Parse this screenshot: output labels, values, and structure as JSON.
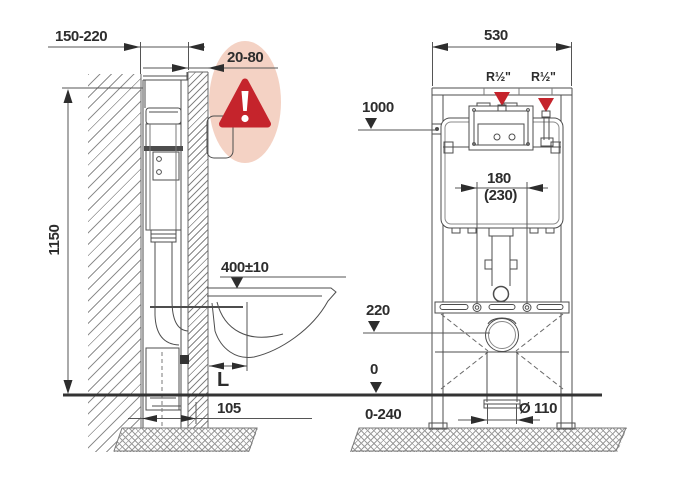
{
  "diagram_title": "wall-hung-wc-installation-frame-dimensions",
  "labels": {
    "left_view": {
      "depth_range": "150-220",
      "cladding_range": "20-80",
      "frame_height": "1150",
      "bowl_height": "400±10",
      "outlet_length": "L",
      "drain_offset": "105"
    },
    "right_view": {
      "frame_width": "530",
      "supply_left": "R½\"",
      "supply_right": "R½\"",
      "level_1000": "1000",
      "bolt_spacing": "180",
      "bolt_spacing_alt": "(230)",
      "outlet_height": "220",
      "floor_level": "0",
      "below_floor_range": "0-240",
      "drain_diameter": "Ø 110"
    }
  },
  "icons": {
    "warning": "warning-triangle-exclamation"
  },
  "colors": {
    "warning_red": "#c5242c",
    "warning_bubble_pink": "#f4d2c4",
    "line_gray": "#4d4d4d",
    "floor_line": "#333333",
    "text": "#2d2d2d"
  }
}
